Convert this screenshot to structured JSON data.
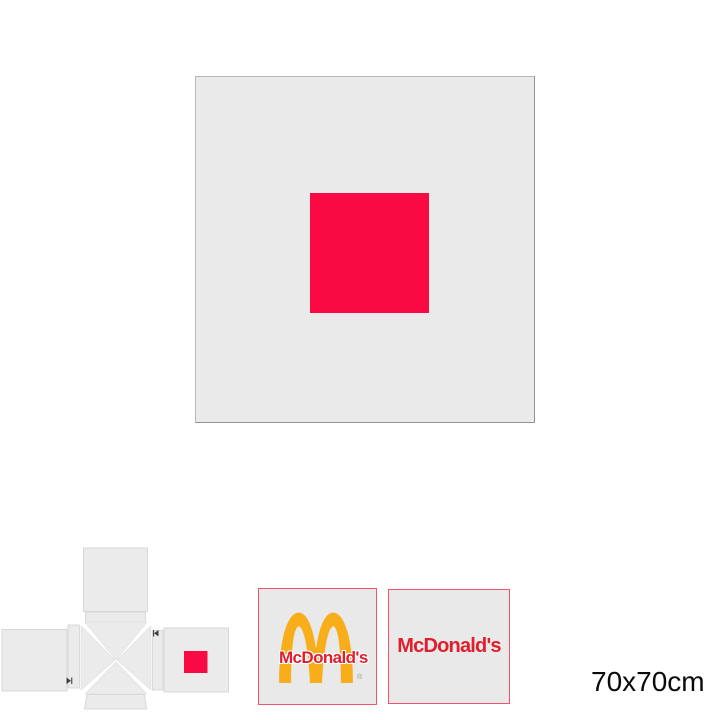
{
  "preview": {
    "design_color": "#fa0a43",
    "canvas_color": "#eaeaea",
    "canvas_border_color": "#a3a3a3"
  },
  "template_net": {
    "panel_color": "#ebebeb",
    "panel_border_color": "#d2d2d2",
    "print_area_color": "#fa0a43",
    "fold_marker_color": "#3f3f3f"
  },
  "swatches": [
    {
      "type": "arches-logo",
      "label": "McDonald's",
      "registered_mark": "®",
      "arches_color": "#f7ae1a",
      "text_color": "#e01e2d",
      "border_color": "#f2536d",
      "background_color": "#e9e9e9"
    },
    {
      "type": "wordmark",
      "label": "McDonald's",
      "text_color": "#e01e2d",
      "border_color": "#f2536d",
      "background_color": "#e9e9e9"
    }
  ],
  "size_label": "70x70cm"
}
